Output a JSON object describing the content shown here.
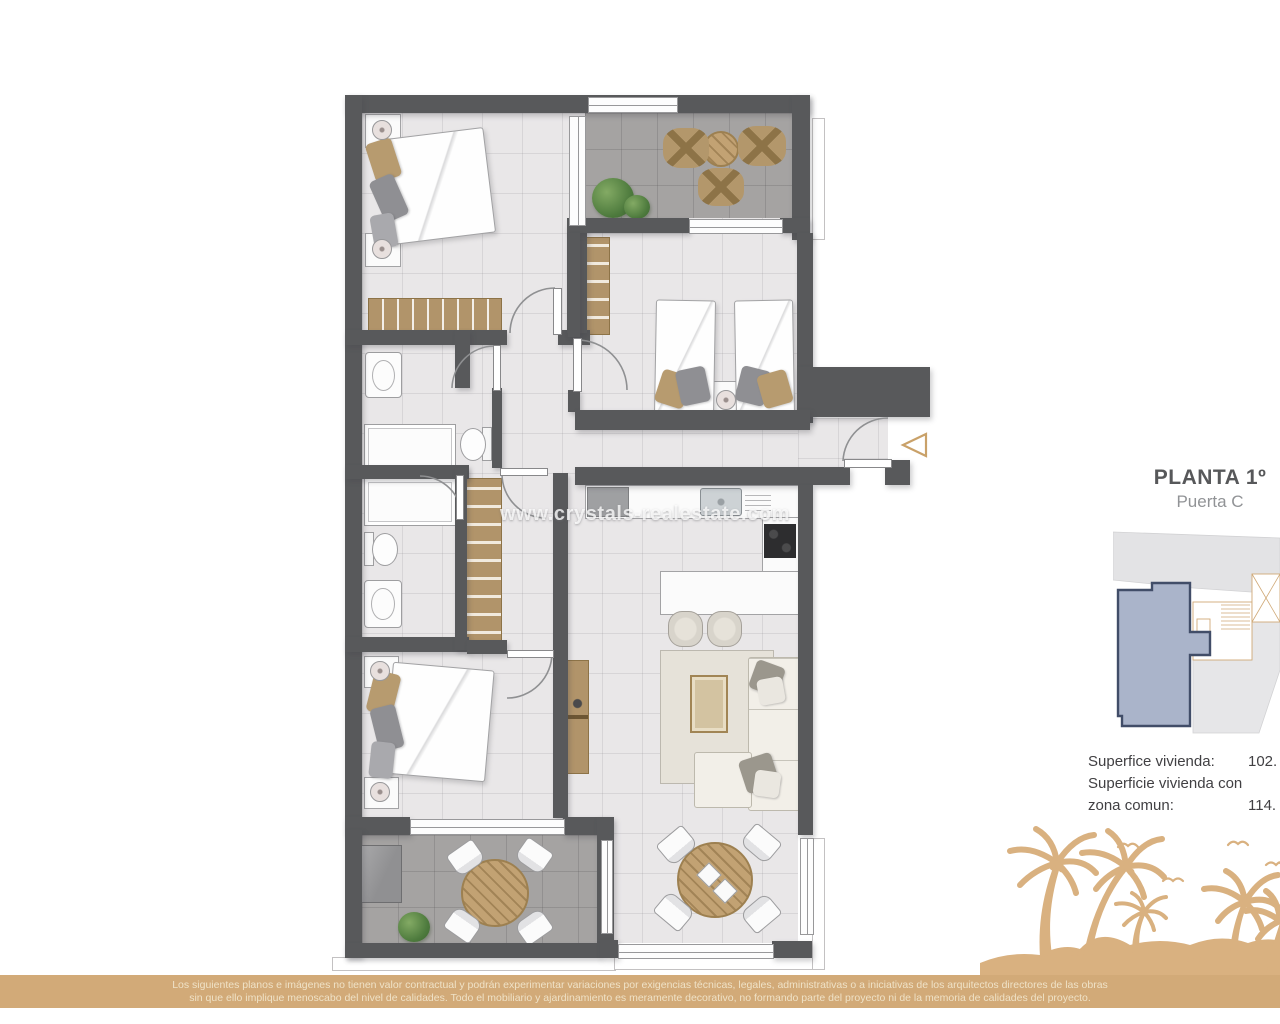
{
  "plan_label": {
    "floor_title": "PLANTA 1º",
    "door_subtitle": "Puerta C"
  },
  "watermark_text": "www.crystals-realestate.com",
  "areas": {
    "surface_label": "Superfice vivienda:",
    "surface_value": "102.",
    "surface_common_label_line1": "Superficie vivienda con",
    "surface_common_label_line2": "zona comun:",
    "surface_common_value": "114."
  },
  "disclaimer": {
    "line1": "Los siguientes planos e imágenes no tienen valor contractual y podrán experimentar variaciones por exigencias técnicas, legales, administrativas o a iniciativas de los arquitectos directores de las obras",
    "line2": "sin que ello implique menoscabo del nivel de calidades. Todo el mobiliario y ajardinamiento es meramente decorativo, no formando parte del proyecto ni de la memoria de calidades del proyecto."
  },
  "colors": {
    "wall": "#58595b",
    "light_floor": "#e9e7e8",
    "terrace_floor": "#a5a3a2",
    "wood_furniture": "#b1946a",
    "disclaimer_bar": "#d2aa78",
    "palm_silhouette": "#d9b180",
    "unit_highlight_fill": "#aab4ca",
    "unit_highlight_border": "#414d68",
    "entrance_marker": "#c9a169"
  },
  "icons": {
    "entrance_marker": "triangle-left-outline",
    "beach_graphic": "palm-trees-and-birds-silhouette"
  }
}
